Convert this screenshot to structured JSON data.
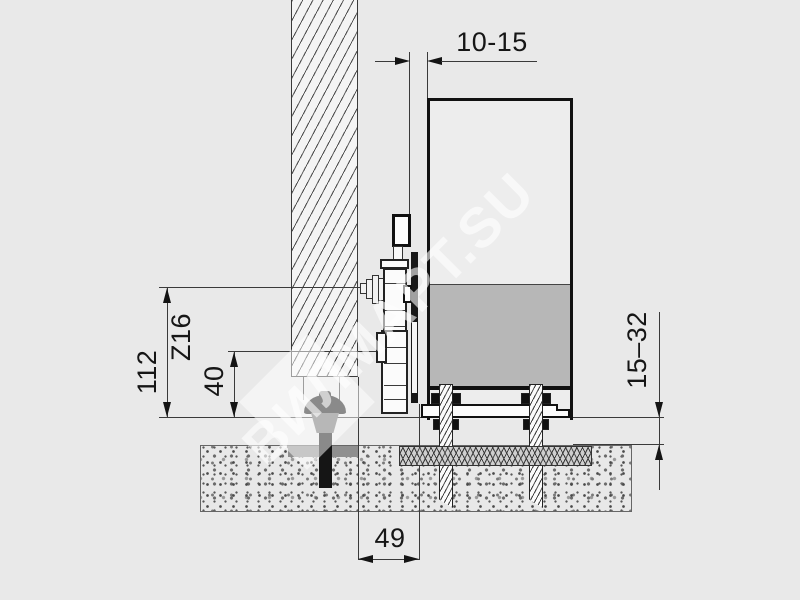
{
  "drawing": {
    "type": "sliding-door bottom mounting cross-section",
    "watermark": {
      "text": "ВИЛМАРТ.SU"
    },
    "labels": {
      "top_gap": "10-15",
      "total_height": "112",
      "profile_code": "Z16",
      "bolt_height": "40",
      "floor_clearance": "15–32",
      "wall_offset": "49"
    },
    "colors": {
      "background": "#e9e9e9",
      "line": "#1a1a1a",
      "panel_fill": "#ededed",
      "panel_insert_gray": "#b7b7b7",
      "base_plate_gray": "#8f8f8f",
      "bolt_black": "#151515",
      "bolt_collar_gray": "#6f6f6f"
    }
  }
}
